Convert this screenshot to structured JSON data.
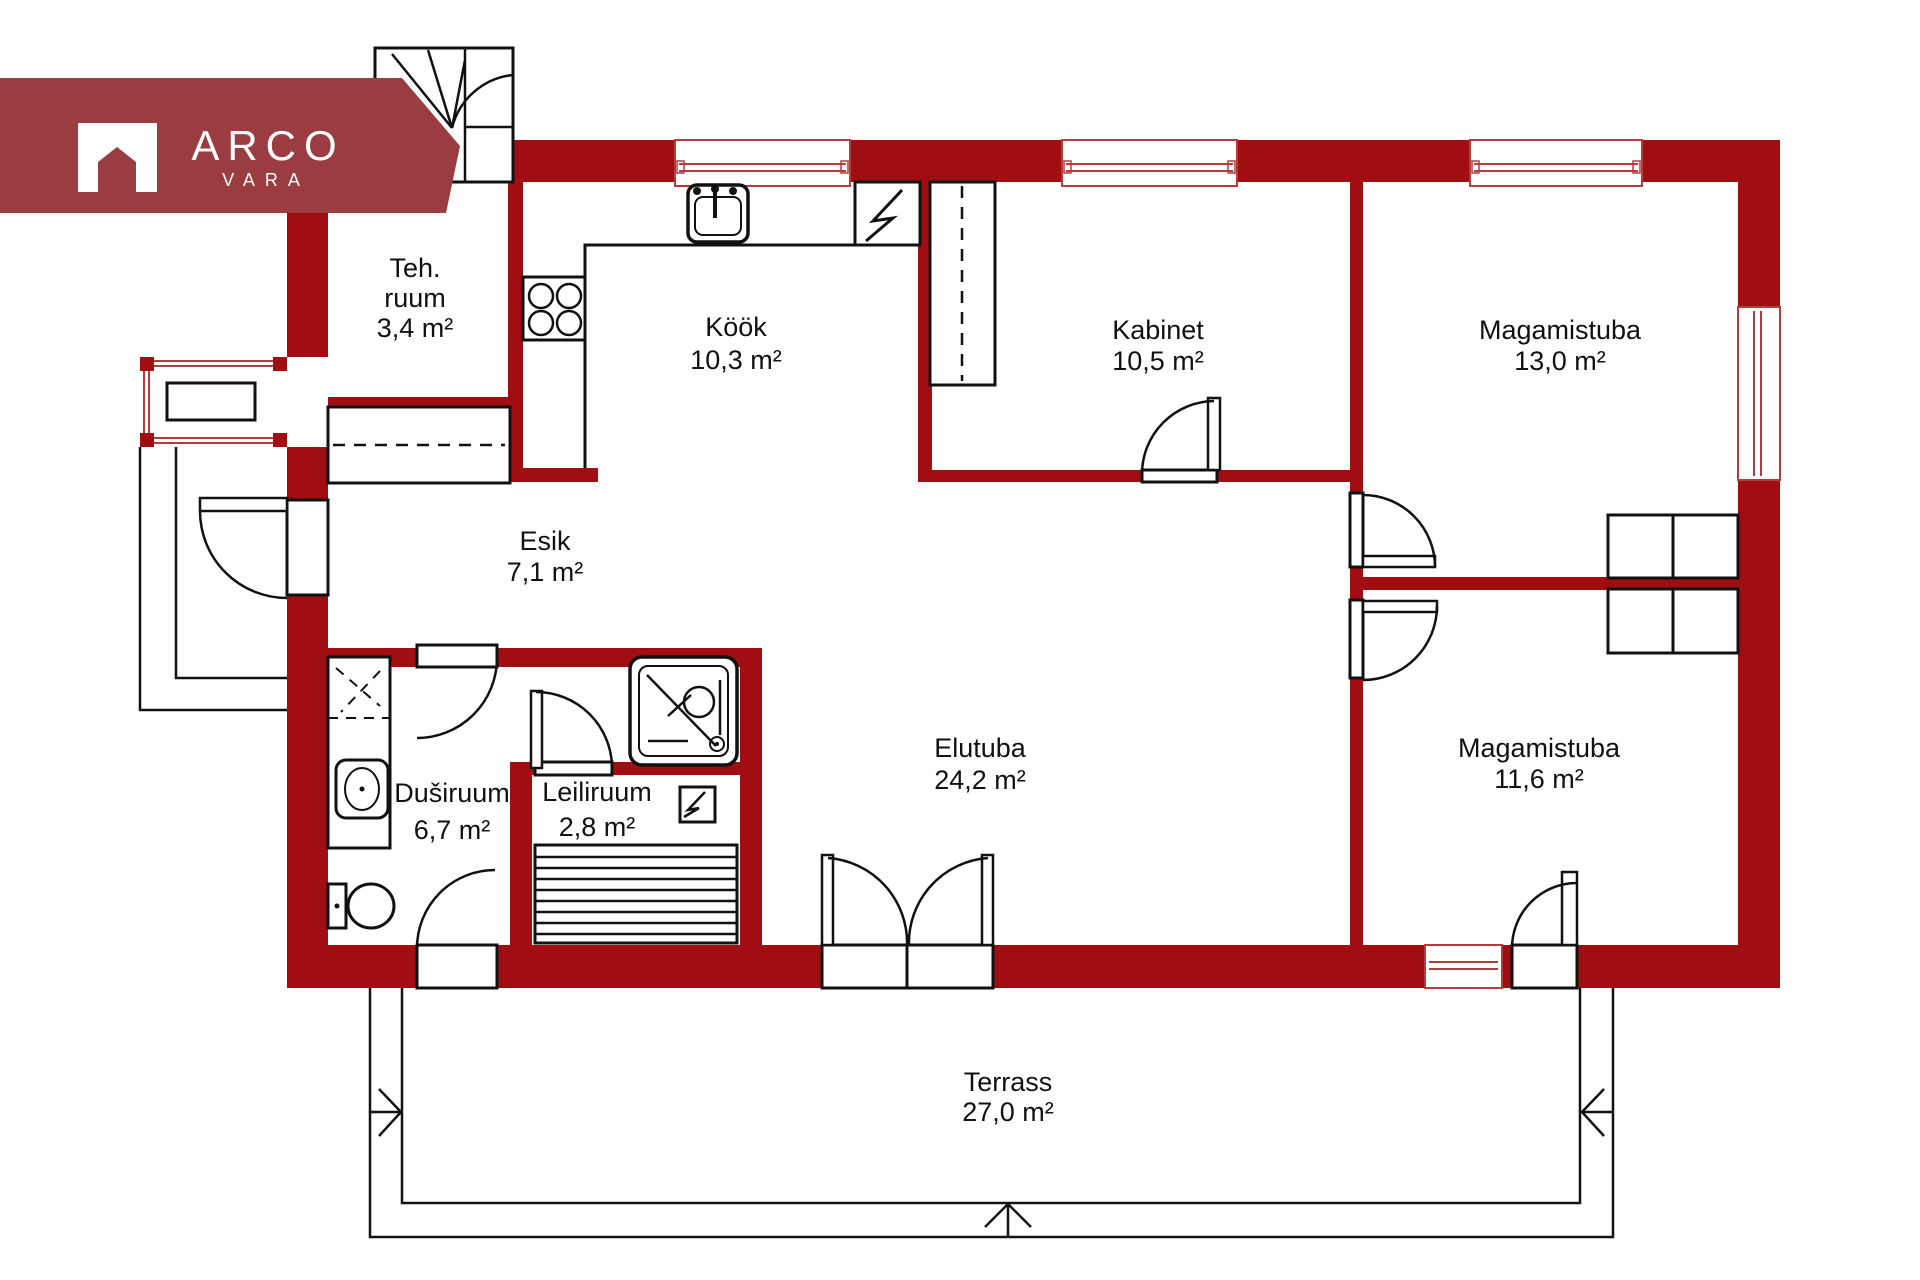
{
  "colors": {
    "wall": "#A00E12",
    "banner": "#9B3C40",
    "window_line": "#B43C3C",
    "line": "#111111"
  },
  "logo": {
    "brand": "ARCO",
    "sub": "VARA"
  },
  "rooms": [
    {
      "line1": "Teh.",
      "line2": "ruum",
      "area": "3,4 m²"
    },
    {
      "line1": "Köök",
      "area": "10,3 m²"
    },
    {
      "line1": "Kabinet",
      "area": "10,5 m²"
    },
    {
      "line1": "Magamistuba",
      "area": "13,0 m²"
    },
    {
      "line1": "Esik",
      "area": "7,1 m²"
    },
    {
      "line1": "Duširuum",
      "area": "6,7 m²"
    },
    {
      "line1": "Leiliruum",
      "area": "2,8 m²"
    },
    {
      "line1": "Elutuba",
      "area": "24,2 m²"
    },
    {
      "line1": "Magamistuba",
      "area": "11,6 m²"
    },
    {
      "line1": "Terrass",
      "area": "27,0 m²"
    }
  ],
  "fixtures": [
    "chimney",
    "kitchen-sink",
    "stove",
    "electrical-panel",
    "tall-cabinet",
    "hall-closet",
    "bay-table",
    "shower",
    "washbasin",
    "toilet",
    "sauna-bench",
    "sauna-heater",
    "wardrobe"
  ]
}
